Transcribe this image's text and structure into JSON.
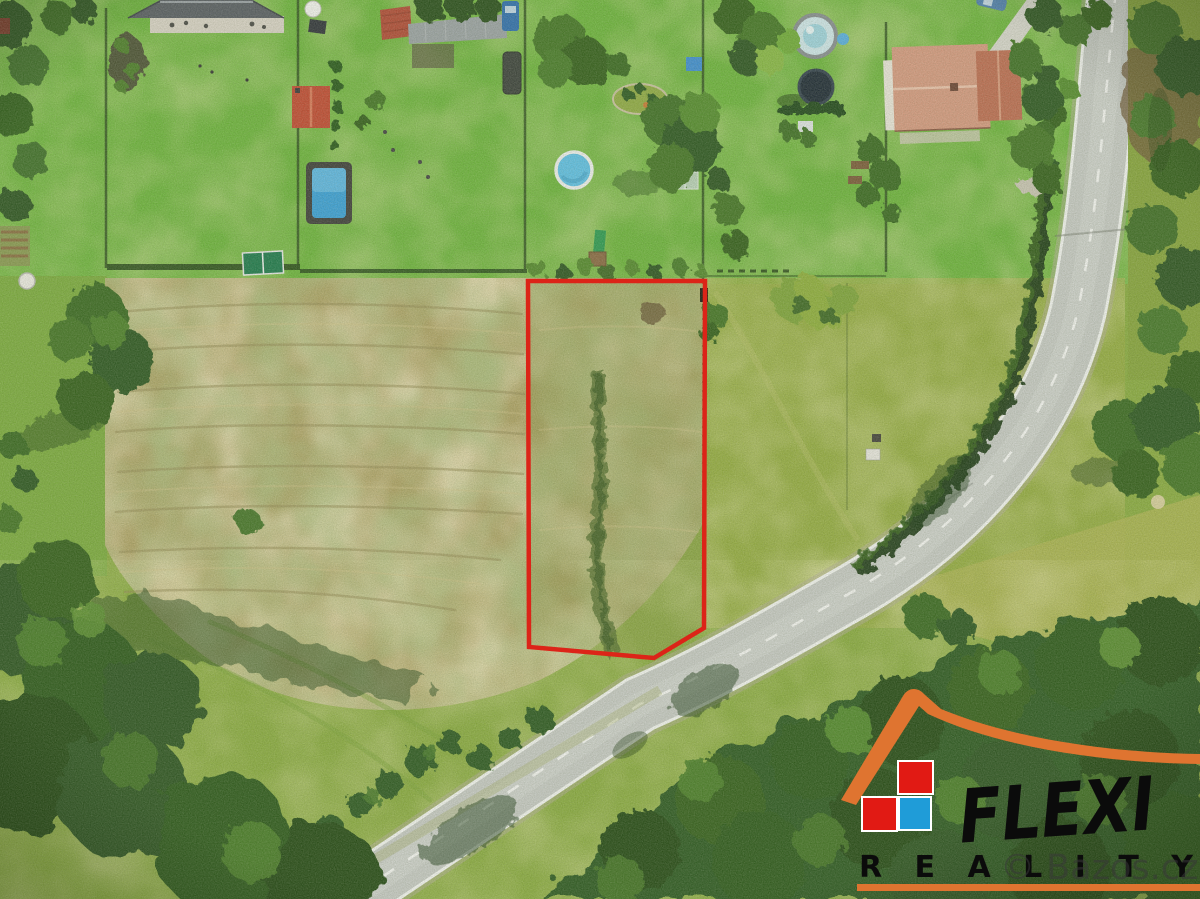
{
  "image": {
    "kind": "aerial-drone-photo-of-building-plot",
    "width": 1200,
    "height": 899
  },
  "plot_boundary": {
    "color": "#dc2418",
    "stroke_width": 4.5,
    "points": "528,281 705,281 704,628 654,658 529,647"
  },
  "logo": {
    "brand": "FLEXI",
    "subtext": "REALITY",
    "roof_color": "#df7430",
    "square_red": "#e11a14",
    "square_blue": "#1f9cd8",
    "text_color": "#0b0b0b",
    "underline_color": "#df7430"
  },
  "watermark": {
    "text": "© Bazos.cz",
    "color": "#383838"
  }
}
